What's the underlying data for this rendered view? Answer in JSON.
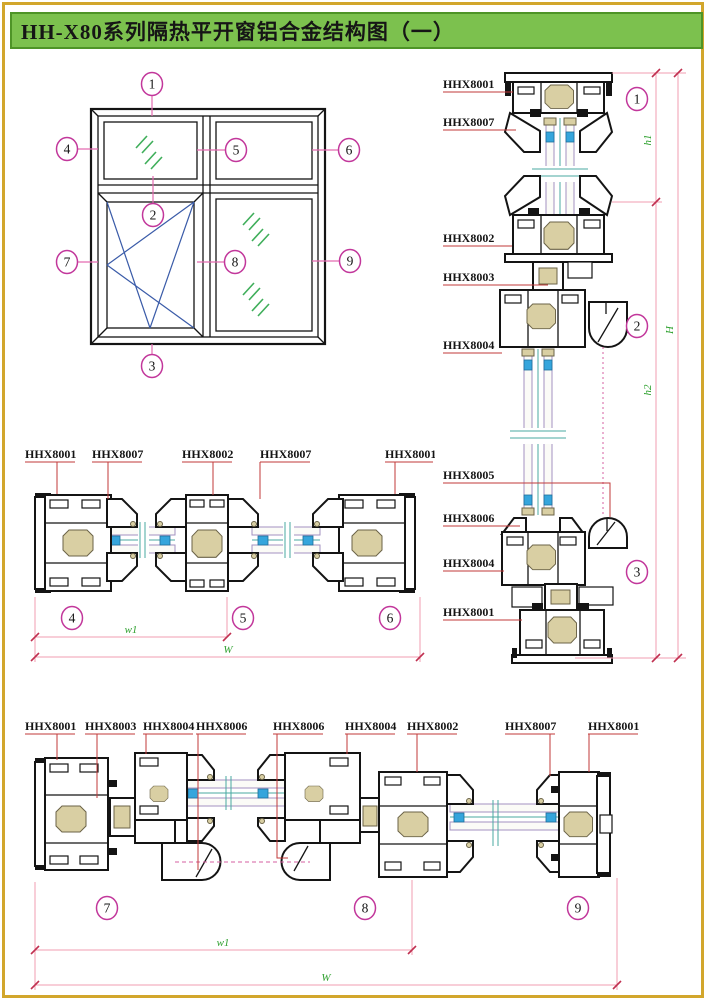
{
  "title": "HH-X80系列隔热平开窗铝合金结构图（一）",
  "colors": {
    "page_border": "#D2A62C",
    "title_bg": "#7CC14E",
    "title_border": "#4E9427",
    "callout_circle": "#C2379B",
    "leader_red": "#C23A3A",
    "dimension_line": "#F29DB0",
    "dimension_text": "#2FA12F",
    "glass_spacer_blue": "#35A5DC",
    "thermal_break_tan": "#D9CFA3",
    "glass_edge_purple": "#A391C0",
    "hatch_green": "#3FAE5A",
    "casement_blue": "#3A5BA8",
    "linework": "#141414"
  },
  "elevation": {
    "callouts": [
      "1",
      "2",
      "3",
      "4",
      "5",
      "6",
      "7",
      "8",
      "9"
    ]
  },
  "vertical_section": {
    "labels": [
      "HHX8001",
      "HHX8007",
      "HHX8002",
      "HHX8003",
      "HHX8004",
      "HHX8005",
      "HHX8006",
      "HHX8004",
      "HHX8001"
    ],
    "callouts": [
      "1",
      "2",
      "3"
    ],
    "dims": {
      "h1": "h1",
      "h2": "h2",
      "H": "H"
    }
  },
  "mid_section": {
    "labels": [
      "HHX8001",
      "HHX8007",
      "HHX8002",
      "HHX8007",
      "HHX8001"
    ],
    "callouts": [
      "4",
      "5",
      "6"
    ],
    "dims": {
      "w1": "w1",
      "W": "W"
    }
  },
  "bottom_section": {
    "labels": [
      "HHX8001",
      "HHX8003",
      "HHX8004",
      "HHX8006",
      "HHX8006",
      "HHX8004",
      "HHX8002",
      "HHX8007",
      "HHX8001"
    ],
    "callouts": [
      "7",
      "8",
      "9"
    ],
    "dims": {
      "w1": "w1",
      "W": "W"
    }
  }
}
